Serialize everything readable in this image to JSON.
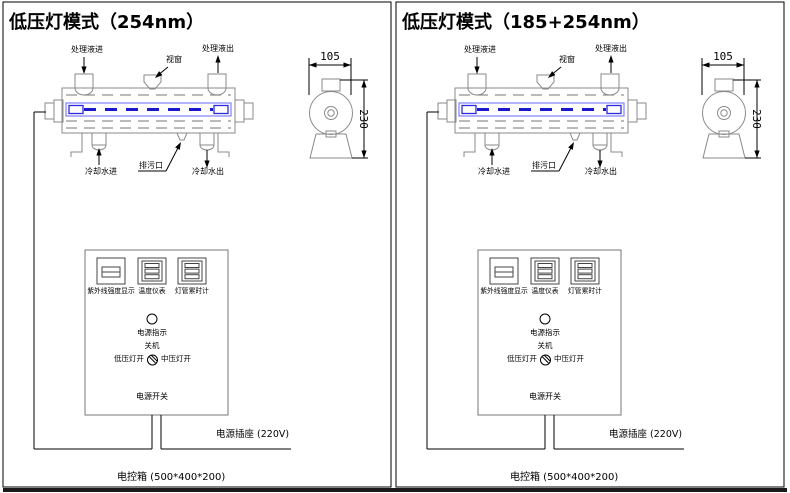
{
  "colors": {
    "line_gray": "#8a8a8a",
    "line_black": "#000000",
    "lamp_outline": "#8080ff",
    "lamp_core": "#1a1acc",
    "lamp_end": "#2a2ae0",
    "bottom_bar": "#1a1a1a"
  },
  "panels": [
    {
      "title": "低压灯模式（254nm）",
      "chamber": {
        "labels": {
          "inlet": "处理液进",
          "window": "视窗",
          "outlet": "处理液出",
          "cooling_in": "冷却水进",
          "drain": "排污口",
          "cooling_out": "冷却水出"
        }
      },
      "side_view": {
        "width_dim": "105",
        "height_dim": "230"
      },
      "control_box": {
        "meters": [
          "紫外线强度显示",
          "温度仪表",
          "灯管累时计"
        ],
        "power_indicator": "电源指示",
        "switch": {
          "top": "关机",
          "left": "低压灯开",
          "right": "中压灯开"
        },
        "power_switch": "电源开关"
      },
      "power_socket": "电源插座 (220V)",
      "control_cabinet": "电控箱 (500*400*200)"
    },
    {
      "title": "低压灯模式（185+254nm）",
      "chamber": {
        "labels": {
          "inlet": "处理液进",
          "window": "视窗",
          "outlet": "处理液出",
          "cooling_in": "冷却水进",
          "drain": "排污口",
          "cooling_out": "冷却水出"
        }
      },
      "side_view": {
        "width_dim": "105",
        "height_dim": "230"
      },
      "control_box": {
        "meters": [
          "紫外线强度显示",
          "温度仪表",
          "灯管累时计"
        ],
        "power_indicator": "电源指示",
        "switch": {
          "top": "关机",
          "left": "低压灯开",
          "right": "中压灯开"
        },
        "power_switch": "电源开关"
      },
      "power_socket": "电源插座 (220V)",
      "control_cabinet": "电控箱 (500*400*200)"
    }
  ]
}
